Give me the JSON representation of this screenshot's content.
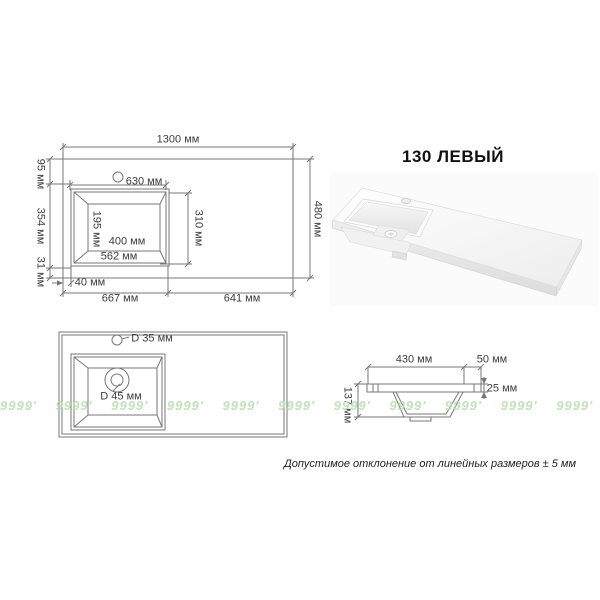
{
  "title": "130 ЛЕВЫЙ",
  "note": "Допустимое отклонение от линейных размеров ± 5 мм",
  "watermark": "9999' 9999' 9999' 9999' 9999' 9999' 9999' 9999' 9999' 9999' 9999'",
  "colors": {
    "line": "#777777",
    "label": "#3d3d3d",
    "watermark_green": "#b9dcae"
  },
  "top_view": {
    "overall_width": "1300 мм",
    "overall_depth": "480 мм",
    "back_edge_to_basin": "95 мм",
    "basin_span": "354 мм",
    "basin_to_front_edge": "31 мм",
    "basin_back_width": "630 мм",
    "drain_offset": "195 мм",
    "basin_bottom_width": "400 мм",
    "basin_top_width": "562 мм",
    "basin_depth": "310 мм",
    "side_offset": "40 мм",
    "left_section": "667 мм",
    "right_section": "641 мм"
  },
  "holes_view": {
    "faucet_hole_diameter": "D 35 мм",
    "drain_hole_diameter": "D 45 мм"
  },
  "section_view": {
    "basin_width": "430 мм",
    "right_offset": "50 мм",
    "slab_thickness": "25 мм",
    "basin_height": "137 мм"
  }
}
